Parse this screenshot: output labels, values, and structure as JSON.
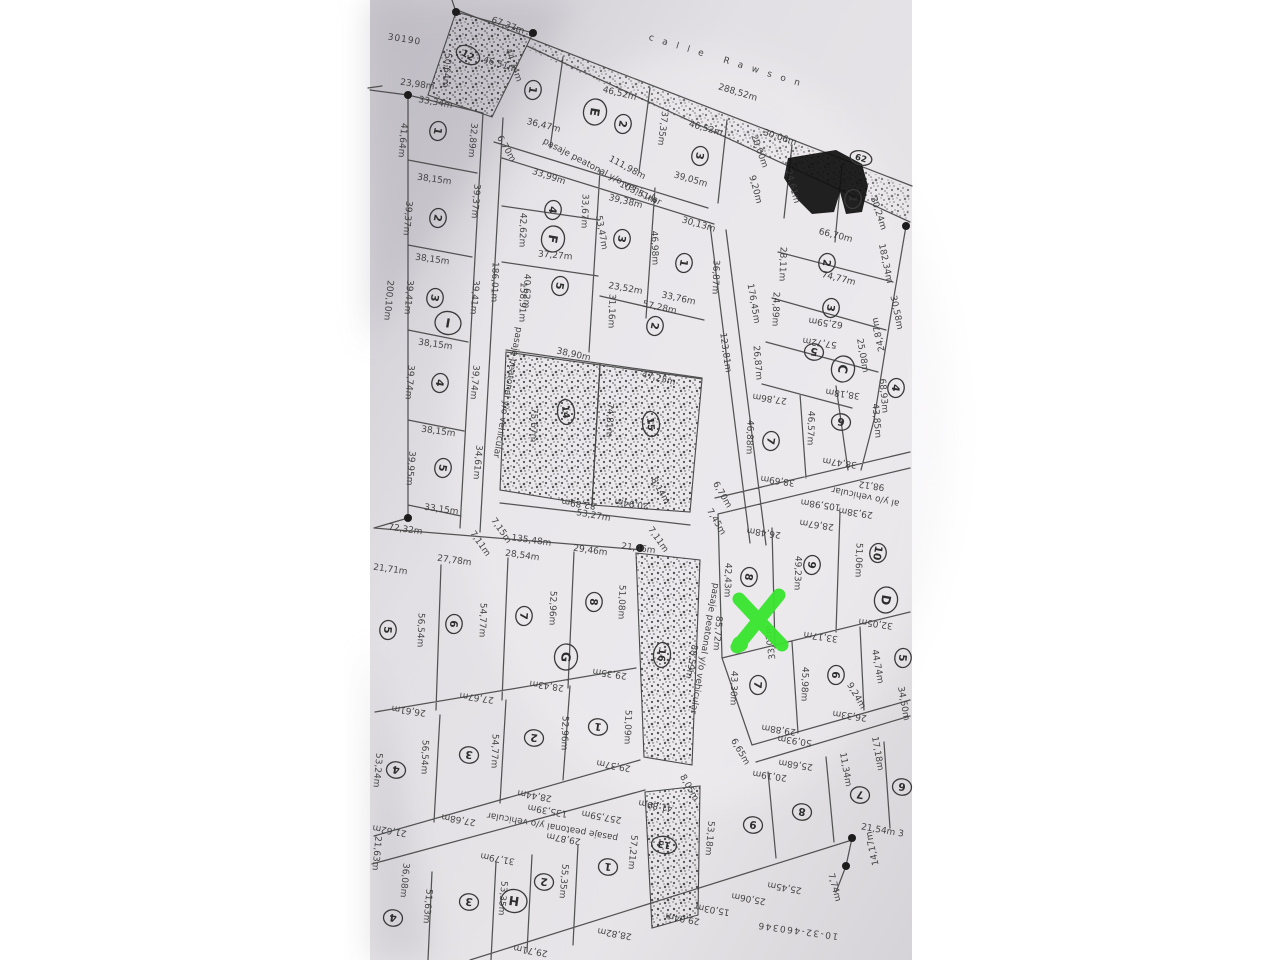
{
  "photo": {
    "kind": "scanned cadastral subdivision plan photo",
    "street_name": "calle Rawson",
    "plan_number": "30190",
    "bottom_reference": "10-32-460346",
    "marker_color": "#38e52e"
  },
  "map": {
    "labels": [
      [
        "30190",
        404,
        42,
        9,
        24,
        1,
        "#4a4a4a"
      ],
      [
        "calle Rawson",
        728,
        64,
        17,
        26,
        9,
        "#5e5e5e"
      ],
      [
        "288,52m",
        737,
        95,
        17
      ],
      [
        "67,37m",
        507,
        28,
        20
      ],
      [
        "46,51m",
        499,
        67,
        17
      ],
      [
        "50,64m",
        444,
        70,
        95
      ],
      [
        "44,74m",
        511,
        66,
        70
      ],
      [
        "23,98m",
        417,
        87,
        8
      ],
      [
        "33,34m",
        435,
        105,
        10
      ],
      [
        "41,64m",
        400,
        140,
        95
      ],
      [
        "32,89m",
        470,
        140,
        95
      ],
      [
        "38,15m",
        434,
        182,
        8
      ],
      [
        "39,37m",
        405,
        218,
        95
      ],
      [
        "39,37m",
        473,
        201,
        95
      ],
      [
        "38,15m",
        432,
        262,
        8
      ],
      [
        "39,41m",
        406,
        297,
        95
      ],
      [
        "39,41m",
        472,
        297,
        95
      ],
      [
        "200,10m",
        386,
        300,
        95,
        11
      ],
      [
        "38,15m",
        435,
        347,
        8
      ],
      [
        "39,74m",
        407,
        382,
        95
      ],
      [
        "39,74m",
        472,
        382,
        95
      ],
      [
        "38,15m",
        438,
        434,
        8
      ],
      [
        "39,95m",
        408,
        468,
        95
      ],
      [
        "34,61m",
        475,
        462,
        95
      ],
      [
        "33,15m",
        441,
        512,
        8
      ],
      [
        "72,32m",
        405,
        532,
        8,
        11
      ],
      [
        "pasaje peatonal y/o vehicular",
        505,
        392,
        100,
        8
      ],
      [
        "6,70m",
        504,
        150,
        60,
        7.5
      ],
      [
        "7,15m",
        499,
        532,
        55,
        7.5
      ],
      [
        "7,11m",
        478,
        545,
        55,
        7.5
      ],
      [
        "36,47m",
        543,
        128,
        14
      ],
      [
        "46,52m",
        619,
        96,
        14
      ],
      [
        "46,52m",
        705,
        131,
        16
      ],
      [
        "37,35m",
        660,
        128,
        97
      ],
      [
        "39,05m",
        690,
        182,
        16
      ],
      [
        "pasaje peatonal y/o vehicular",
        601,
        174,
        28,
        8
      ],
      [
        "111,98m",
        626,
        170,
        28
      ],
      [
        "103,51m",
        637,
        195,
        26
      ],
      [
        "39,38m",
        625,
        204,
        14
      ],
      [
        "33,99m",
        548,
        179,
        18
      ],
      [
        "42,62m",
        520,
        230,
        92
      ],
      [
        "33,67m",
        582,
        211,
        92
      ],
      [
        "37,27m",
        555,
        258,
        5
      ],
      [
        "40,62m",
        524,
        291,
        92
      ],
      [
        "186,01m",
        492,
        282,
        92,
        10
      ],
      [
        "158,91m",
        520,
        302,
        92,
        10
      ],
      [
        "53,47m",
        599,
        233,
        80
      ],
      [
        "46,98m",
        652,
        248,
        88
      ],
      [
        "30,13m",
        698,
        227,
        16
      ],
      [
        "36,87m",
        713,
        277,
        92
      ],
      [
        "23,52m",
        625,
        291,
        10
      ],
      [
        "33,76m",
        678,
        301,
        12
      ],
      [
        "57,28m",
        659,
        310,
        12
      ],
      [
        "31,16m",
        609,
        311,
        92
      ],
      [
        "30,06m",
        779,
        140,
        18
      ],
      [
        "20,00m",
        757,
        152,
        70,
        7.5
      ],
      [
        "9,20m",
        753,
        190,
        75,
        7.5
      ],
      [
        "24,61m",
        790,
        187,
        75
      ],
      [
        "30,24m",
        876,
        214,
        72
      ],
      [
        "182,34m",
        883,
        264,
        78,
        9
      ],
      [
        "30,58m",
        894,
        313,
        78
      ],
      [
        "24,87m",
        881,
        334,
        258
      ],
      [
        "25,08m",
        860,
        356,
        80
      ],
      [
        "66,70m",
        835,
        238,
        14
      ],
      [
        "74,77m",
        838,
        281,
        14
      ],
      [
        "28,11m",
        780,
        264,
        92
      ],
      [
        "62,59m",
        826,
        320,
        188
      ],
      [
        "24,89m",
        773,
        309,
        92
      ],
      [
        "57,72m",
        820,
        340,
        188
      ],
      [
        "176,45m",
        751,
        304,
        80,
        9
      ],
      [
        "123,81m",
        723,
        353,
        82,
        9
      ],
      [
        "26,87m",
        755,
        363,
        85
      ],
      [
        "27,86m",
        770,
        396,
        188
      ],
      [
        "38,18m",
        843,
        391,
        188
      ],
      [
        "46,88m",
        747,
        437,
        92
      ],
      [
        "46,57m",
        808,
        428,
        92
      ],
      [
        "38,47m",
        840,
        460,
        188
      ],
      [
        "43,85m",
        874,
        421,
        85
      ],
      [
        "68,93m",
        881,
        396,
        85
      ],
      [
        "38,69m",
        778,
        478,
        188
      ],
      [
        "6,70m",
        720,
        496,
        60,
        7.5
      ],
      [
        "7,45m",
        714,
        523,
        60,
        7.5
      ],
      [
        "38,90m",
        573,
        357,
        12
      ],
      [
        "47,25m",
        658,
        381,
        14
      ],
      [
        "75,67m",
        531,
        425,
        92
      ],
      [
        "74,81m",
        607,
        420,
        92
      ],
      [
        "82,89m",
        579,
        501,
        188
      ],
      [
        "20,94m",
        632,
        501,
        188
      ],
      [
        "53,27m",
        593,
        518,
        10,
        11
      ],
      [
        "8,14m",
        658,
        492,
        60,
        7.5
      ],
      [
        "7,11m",
        656,
        541,
        55,
        7.5
      ],
      [
        "105,98m",
        821,
        502,
        188,
        9
      ],
      [
        "98,12",
        872,
        483,
        188
      ],
      [
        "al y/o vehicular",
        866,
        494,
        192,
        8
      ],
      [
        "26,48m",
        764,
        530,
        188
      ],
      [
        "28,67m",
        817,
        522,
        188
      ],
      [
        "29,38m",
        856,
        510,
        188
      ],
      [
        "42,43m",
        725,
        580,
        92
      ],
      [
        "49,23m",
        795,
        573,
        92
      ],
      [
        "51,06m",
        856,
        560,
        92
      ],
      [
        "85,72m",
        715,
        633,
        95
      ],
      [
        "88,59m",
        689,
        661,
        100
      ],
      [
        "pasaje peatonal y/o vehicular",
        702,
        648,
        100,
        8
      ],
      [
        "33,07m",
        773,
        642,
        262
      ],
      [
        "33,17m",
        821,
        634,
        188
      ],
      [
        "32,05m",
        876,
        621,
        188
      ],
      [
        "44,74m",
        875,
        667,
        80
      ],
      [
        "43,30m",
        731,
        688,
        92
      ],
      [
        "45,98m",
        802,
        684,
        92
      ],
      [
        "9,24m",
        854,
        697,
        60,
        7.5
      ],
      [
        "26,33m",
        850,
        713,
        188
      ],
      [
        "34,50m",
        901,
        704,
        80
      ],
      [
        "29,88m",
        779,
        727,
        188
      ],
      [
        "50,93m",
        795,
        738,
        188
      ],
      [
        "6,65m",
        738,
        753,
        60,
        7.5
      ],
      [
        "135,48m",
        531,
        543,
        8,
        11
      ],
      [
        "21,46m",
        638,
        551,
        8
      ],
      [
        "29,46m",
        590,
        553,
        8
      ],
      [
        "28,54m",
        522,
        558,
        8
      ],
      [
        "27,78m",
        454,
        563,
        8
      ],
      [
        "21,71m",
        390,
        572,
        8
      ],
      [
        "56,54m",
        418,
        630,
        92
      ],
      [
        "54,77m",
        480,
        620,
        92
      ],
      [
        "52,96m",
        550,
        608,
        92
      ],
      [
        "51,08m",
        619,
        602,
        92
      ],
      [
        "26,61m",
        409,
        708,
        188
      ],
      [
        "27,67m",
        477,
        695,
        188
      ],
      [
        "28,43m",
        547,
        683,
        188
      ],
      [
        "29,35m",
        610,
        671,
        188
      ],
      [
        "56,54m",
        422,
        757,
        92
      ],
      [
        "54,77m",
        492,
        751,
        92
      ],
      [
        "52,96m",
        562,
        733,
        92
      ],
      [
        "51,09m",
        625,
        727,
        92
      ],
      [
        "21,62m",
        390,
        828,
        190
      ],
      [
        "27,68m",
        459,
        817,
        190
      ],
      [
        "28,44m",
        535,
        793,
        190
      ],
      [
        "135,39m",
        548,
        808,
        190,
        10
      ],
      [
        "29,37m",
        614,
        763,
        190
      ],
      [
        "257,59m",
        602,
        814,
        190,
        10
      ],
      [
        "29,87m",
        564,
        836,
        190
      ],
      [
        "pasaje peatonal y/o vehicular",
        553,
        824,
        190,
        8
      ],
      [
        "31,79m",
        498,
        856,
        190
      ],
      [
        "21,63m",
        374,
        853,
        95
      ],
      [
        "53,24m",
        375,
        770,
        95
      ],
      [
        "36,08m",
        402,
        880,
        95
      ],
      [
        "51,63m",
        425,
        906,
        95
      ],
      [
        "53,35m",
        500,
        898,
        95
      ],
      [
        "55,35m",
        561,
        881,
        95
      ],
      [
        "57,21m",
        630,
        852,
        95
      ],
      [
        "29,71m",
        531,
        948,
        190
      ],
      [
        "28,82m",
        615,
        931,
        190
      ],
      [
        "29,04m",
        683,
        916,
        190
      ],
      [
        "15,03m",
        713,
        907,
        190
      ],
      [
        "25,06m",
        749,
        896,
        190
      ],
      [
        "25,45m",
        785,
        885,
        190
      ],
      [
        "41,89m",
        656,
        803,
        190
      ],
      [
        "8,05m",
        687,
        789,
        60,
        7.5
      ],
      [
        "53,18m",
        707,
        838,
        95
      ],
      [
        "10-32-460346",
        798,
        928,
        188,
        18,
        1.5,
        "#4a4a4a"
      ],
      [
        "20,19m",
        770,
        773,
        188
      ],
      [
        "25,68m",
        796,
        762,
        188
      ],
      [
        "11,34m",
        843,
        770,
        80
      ],
      [
        "17,18m",
        875,
        754,
        80
      ],
      [
        "21,54m 3",
        882,
        833,
        10
      ],
      [
        "14,17m",
        875,
        848,
        258
      ],
      [
        "7,74m",
        832,
        888,
        75
      ]
    ],
    "lot_circles": [
      [
        "1",
        438,
        131,
        "n",
        100
      ],
      [
        "2",
        438,
        218,
        "n",
        100
      ],
      [
        "3",
        435,
        298,
        "n",
        100
      ],
      [
        "I",
        448,
        323,
        "m",
        10
      ],
      [
        "4",
        440,
        383,
        "n",
        100
      ],
      [
        "5",
        443,
        468,
        "n",
        100
      ],
      [
        "12",
        468,
        55,
        "s",
        30
      ],
      [
        "1",
        533,
        90,
        "n",
        100
      ],
      [
        "E",
        595,
        112,
        "m",
        100
      ],
      [
        "2",
        623,
        124,
        "n",
        100
      ],
      [
        "3",
        700,
        156,
        "n",
        100
      ],
      [
        "4",
        553,
        210,
        "n",
        100
      ],
      [
        "F",
        553,
        239,
        "m",
        100
      ],
      [
        "5",
        560,
        286,
        "n",
        100
      ],
      [
        "3",
        622,
        239,
        "n",
        100
      ],
      [
        "1",
        684,
        263,
        "n",
        100
      ],
      [
        "2",
        655,
        326,
        "n",
        100
      ],
      [
        "62",
        861,
        158,
        "w",
        15
      ],
      [
        "1",
        853,
        199,
        "n",
        100
      ],
      [
        "2",
        827,
        263,
        "n",
        100
      ],
      [
        "3",
        831,
        308,
        "n",
        100
      ],
      [
        "5",
        814,
        352,
        "n",
        190
      ],
      [
        "C",
        843,
        369,
        "m",
        100
      ],
      [
        "6",
        841,
        422,
        "n",
        190
      ],
      [
        "4",
        896,
        388,
        "n",
        100
      ],
      [
        "7",
        771,
        441,
        "n",
        100
      ],
      [
        "14",
        566,
        412,
        "s",
        85
      ],
      [
        "15",
        651,
        424,
        "s",
        85
      ],
      [
        "5",
        388,
        630,
        "n",
        95
      ],
      [
        "6",
        454,
        624,
        "n",
        95
      ],
      [
        "7",
        524,
        616,
        "n",
        95
      ],
      [
        "8",
        594,
        602,
        "n",
        95
      ],
      [
        "G",
        566,
        657,
        "m",
        95
      ],
      [
        "4",
        396,
        770,
        "n",
        188
      ],
      [
        "3",
        469,
        755,
        "n",
        188
      ],
      [
        "2",
        534,
        738,
        "n",
        188
      ],
      [
        "1",
        598,
        727,
        "n",
        188
      ],
      [
        "8",
        749,
        577,
        "n",
        100
      ],
      [
        "9",
        812,
        565,
        "n",
        100
      ],
      [
        "10",
        878,
        553,
        "n",
        100
      ],
      [
        "D",
        886,
        600,
        "m",
        100
      ],
      [
        "7",
        758,
        685,
        "n",
        95
      ],
      [
        "6",
        836,
        675,
        "n",
        95
      ],
      [
        "5",
        903,
        658,
        "n",
        95
      ],
      [
        "16",
        662,
        655,
        "s",
        95
      ],
      [
        "9",
        753,
        825,
        "n",
        188
      ],
      [
        "8",
        802,
        812,
        "n",
        188
      ],
      [
        "7",
        860,
        795,
        "n",
        188
      ],
      [
        "6",
        902,
        787,
        "n",
        188
      ],
      [
        "4",
        393,
        918,
        "n",
        188
      ],
      [
        "3",
        469,
        902,
        "n",
        188
      ],
      [
        "H",
        514,
        901,
        "m",
        188
      ],
      [
        "2",
        544,
        882,
        "n",
        188
      ],
      [
        "1",
        608,
        867,
        "n",
        188
      ],
      [
        "13",
        664,
        845,
        "s",
        190
      ]
    ],
    "vertex_dots": [
      [
        456,
        12
      ],
      [
        533,
        33
      ],
      [
        408,
        95
      ],
      [
        408,
        518
      ],
      [
        640,
        548
      ],
      [
        852,
        838
      ],
      [
        846,
        866
      ],
      [
        906,
        226
      ]
    ]
  }
}
